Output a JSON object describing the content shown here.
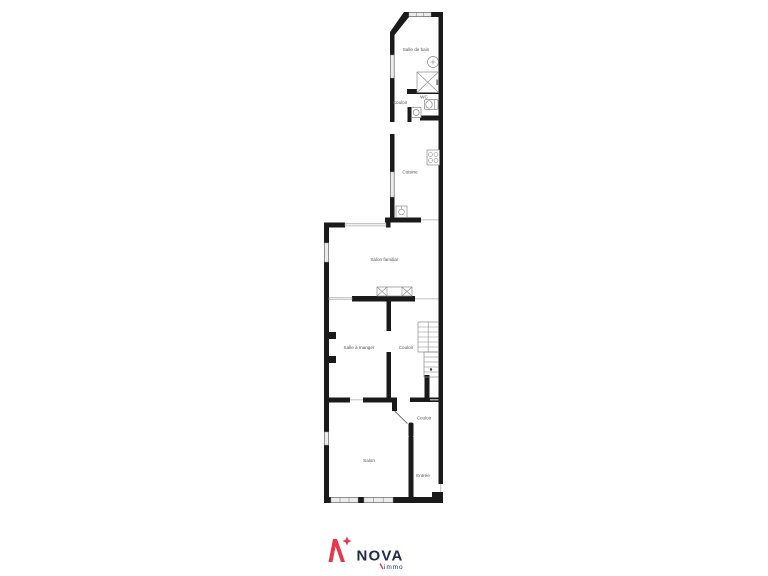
{
  "floorplan": {
    "wall_color": "#1a1a1a",
    "fixture_color": "#8a8a8a",
    "window_color": "#ececec",
    "label_color": "#555555",
    "rooms": [
      {
        "id": "salle-de-bain",
        "label": "Salle de bain"
      },
      {
        "id": "couloir-haut",
        "label": "Couloir"
      },
      {
        "id": "wc",
        "label": "WC"
      },
      {
        "id": "cuisine",
        "label": "Cuisine"
      },
      {
        "id": "salon-familial",
        "label": "Salon familial"
      },
      {
        "id": "salle-a-manger",
        "label": "Salle à manger"
      },
      {
        "id": "couloir-etage",
        "label": "Couloir"
      },
      {
        "id": "couloir-bas",
        "label": "Couloir"
      },
      {
        "id": "salon",
        "label": "Salon"
      },
      {
        "id": "entree",
        "label": "Entrée"
      }
    ],
    "fixtures": [
      "bathroom-sink",
      "shower",
      "toilet",
      "wc-sink",
      "stove",
      "kitchen-sink",
      "sideboard",
      "staircase"
    ]
  },
  "logo": {
    "brand": "NOVA",
    "subtitle": "immo",
    "red": "#e8364b",
    "navy": "#1e2b4d"
  }
}
